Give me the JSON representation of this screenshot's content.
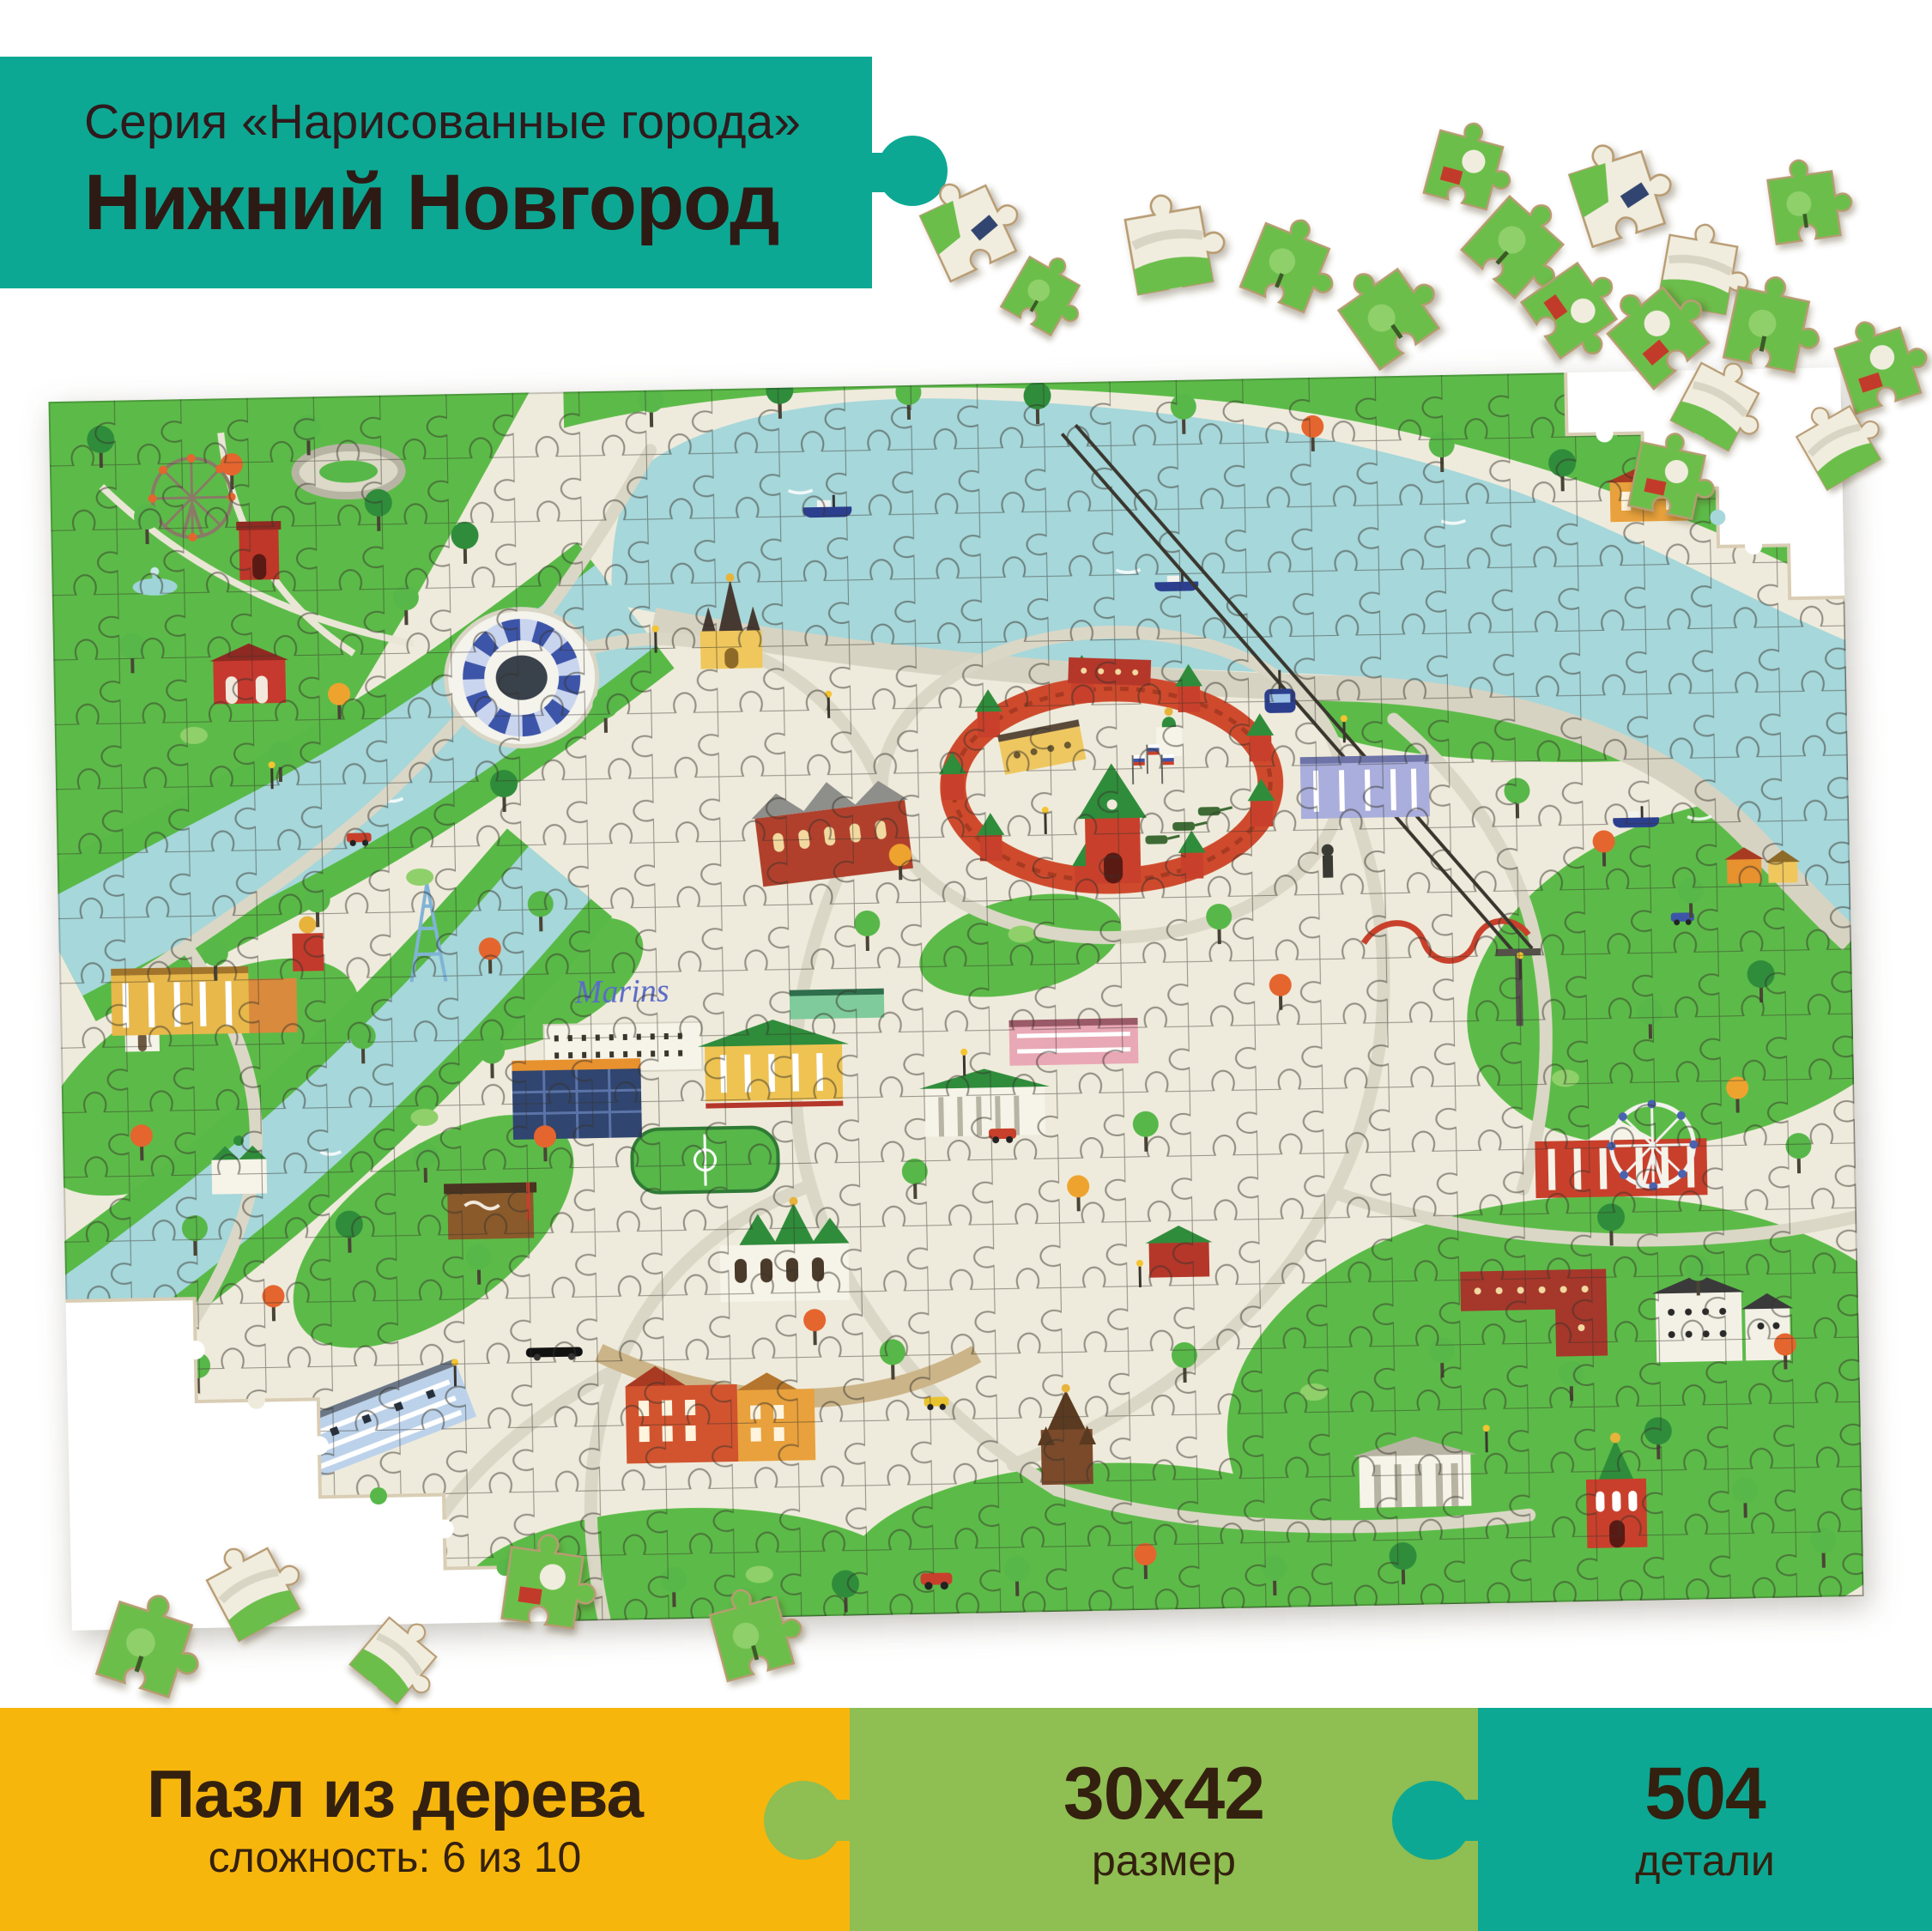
{
  "product": {
    "series": "Серия «Нарисованные города»",
    "title": "Нижний Новгород"
  },
  "map_photo": {
    "hotel_sign": "Marins"
  },
  "panels": {
    "material": {
      "title": "Пазл из дерева",
      "subtitle": "сложность: 6 из 10"
    },
    "size": {
      "title": "30x42",
      "subtitle": "размер"
    },
    "pieces": {
      "title": "504",
      "subtitle": "детали"
    }
  },
  "colors": {
    "teal": "#0DA893",
    "yellow": "#F7B60C",
    "green_panel": "#8FBE52",
    "text_dark": "#33200F",
    "map_cream": "#EFEBDC",
    "river_blue": "#A6D7DA",
    "park_green": "#5CBB48",
    "kremlin_red": "#C8402B"
  },
  "icons": {
    "puzzle_knob": "circle-tab",
    "puzzle_piece": "jigsaw-shape"
  }
}
